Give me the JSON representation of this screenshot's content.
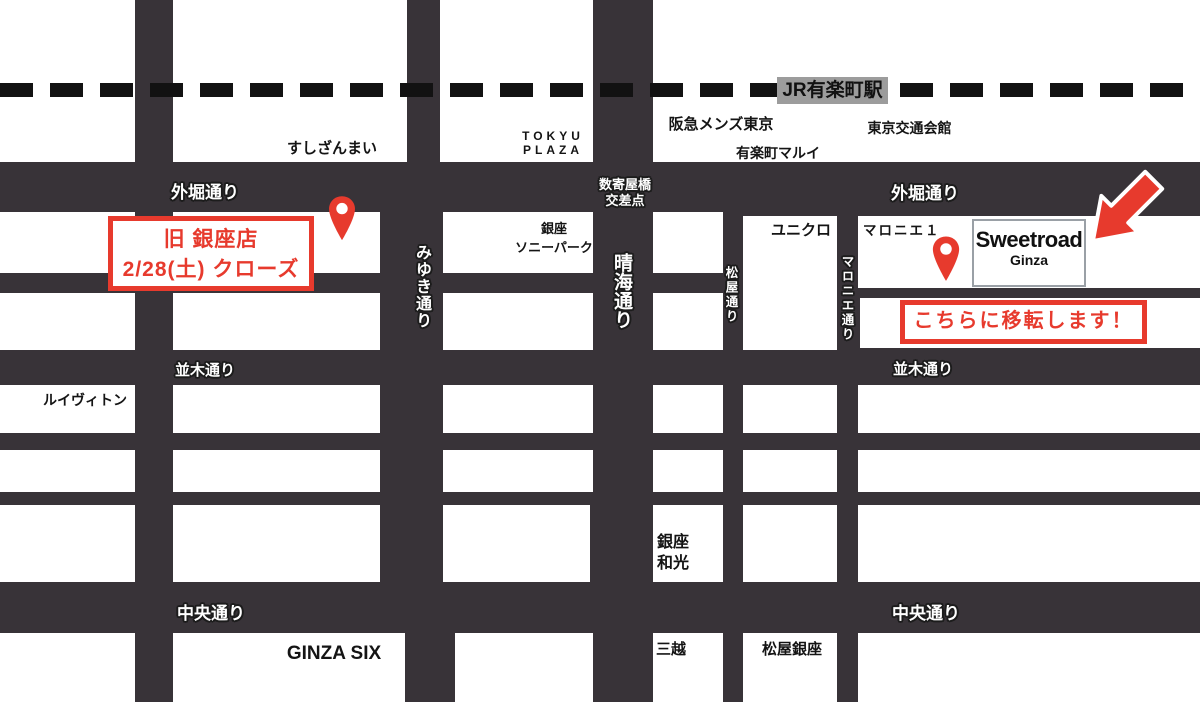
{
  "colors": {
    "road": "#383338",
    "block": "#ffffff",
    "accent_red": "#e73a2d",
    "station_badge_bg": "#9c9c9c",
    "railway_dash": "#121212",
    "sign_border": "#9aa0a6"
  },
  "railway": {
    "station_badge": "JR有楽町駅"
  },
  "roads": {
    "sotobori": "外堀通り",
    "namiki": "並木通り",
    "chuo": "中央通り",
    "miyuki": "みゆき通り",
    "harumi": "晴海通り",
    "matsuya": "松屋通り",
    "marronnier": "マロニエ通り",
    "sukiyabashi_l1": "数寄屋橋",
    "sukiyabashi_l2": "交差点"
  },
  "landmarks": {
    "sushizanmai": "すしざんまい",
    "tokyu_l1": "TOKYU",
    "tokyu_l2": "PLAZA",
    "hankyu": "阪急メンズ東京",
    "kotsukaikan": "東京交通会館",
    "marui": "有楽町マルイ",
    "sonypark_l1": "銀座",
    "sonypark_l2": "ソニーパーク",
    "uniqlo": "ユニクロ",
    "marronnier1": "マロニエ１",
    "louisvuitton": "ルイヴィトン",
    "wako_l1": "銀座",
    "wako_l2": "和光",
    "ginzasix": "GINZA SIX",
    "mitsukoshi": "三越",
    "matsuyaginza": "松屋銀座"
  },
  "old_store": {
    "line1": "旧 銀座店",
    "line2": "2/28(土) クローズ"
  },
  "new_store": {
    "name": "Sweetroad",
    "subname": "Ginza",
    "note": "こちらに移転します！"
  }
}
